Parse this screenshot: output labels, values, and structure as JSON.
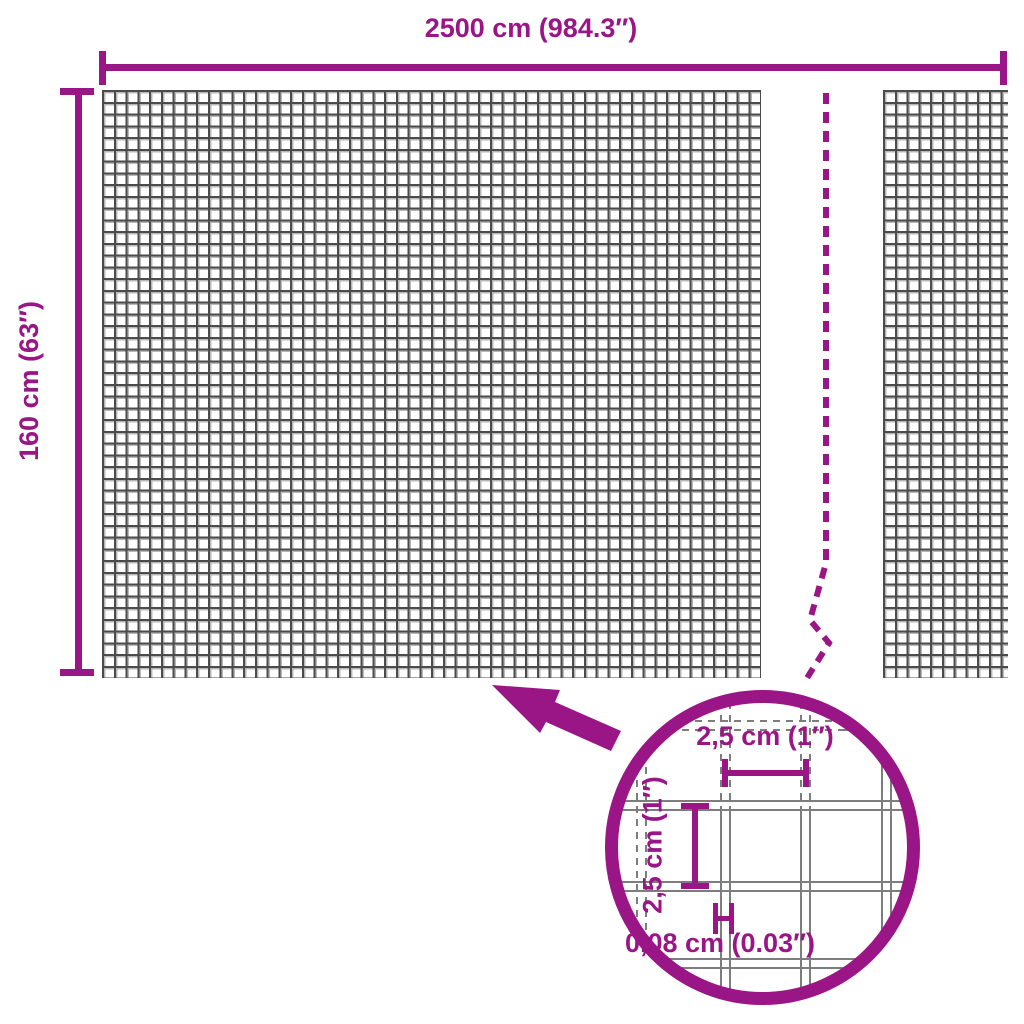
{
  "diagram": {
    "type": "product-dimension-diagram",
    "subject": "garden wire mesh fence",
    "width_label": "2500 cm (984.3″)",
    "height_label": "160 cm (63″)",
    "magnifier": {
      "mesh_width_label": "2,5 cm (1″)",
      "mesh_height_label": "2,5 cm (1″)",
      "wire_thickness_label": "0,08 cm (0.03″)"
    },
    "colors": {
      "accent": "#9A1585",
      "grid_dark": "#4b4b4b",
      "grid_light": "#b8b8b8",
      "wire_gray": "#7d7d7d"
    }
  }
}
